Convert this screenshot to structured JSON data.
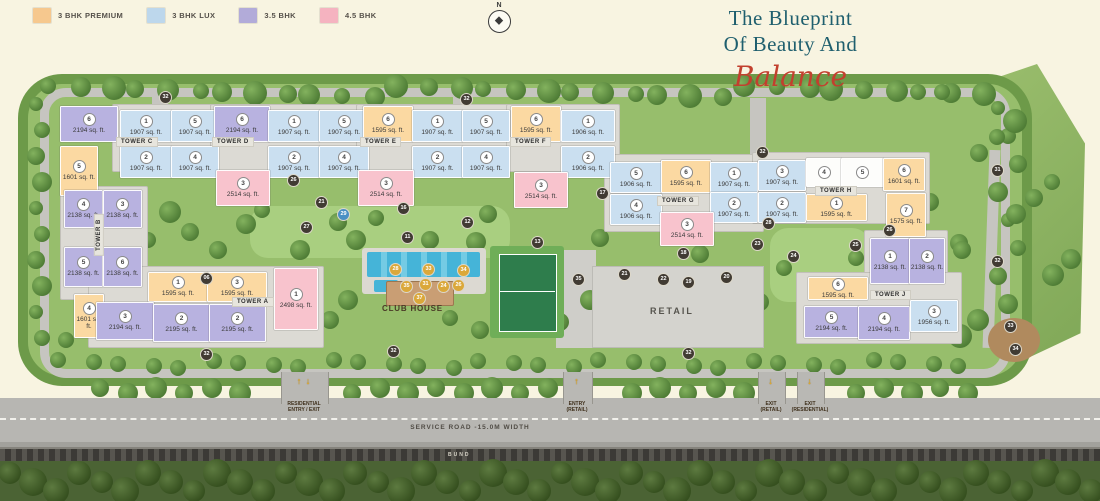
{
  "legend": {
    "items": [
      {
        "label": "3 BHK PREMIUM",
        "key": "premium"
      },
      {
        "label": "3 BHK LUX",
        "key": "lux"
      },
      {
        "label": "3.5 BHK",
        "key": "bhk35"
      },
      {
        "label": "4.5 BHK",
        "key": "bhk45"
      }
    ]
  },
  "colors": {
    "premium": "#f6c88e",
    "lux": "#bdd7ec",
    "bhk35": "#b2abd9",
    "bhk45": "#f5b3c0",
    "white": "#fdfdfb",
    "unit_premium": "#fbd9a2",
    "unit_lux": "#cadff0",
    "unit_bhk35": "#b8b2e0",
    "unit_bhk45": "#f8c3cd",
    "title_teal": "#1f5f6e",
    "script_red": "#c2402e"
  },
  "title": {
    "line1": "The Blueprint",
    "line2": "Of Beauty And",
    "script": "Balance"
  },
  "compass": {
    "label": "N"
  },
  "plan": {
    "club_house_label": "CLUB HOUSE",
    "retail_label": "RETAIL",
    "tower_labels": [
      {
        "text": "TOWER C",
        "x": 116,
        "y": 137
      },
      {
        "text": "TOWER D",
        "x": 212,
        "y": 137
      },
      {
        "text": "TOWER E",
        "x": 360,
        "y": 137
      },
      {
        "text": "TOWER F",
        "x": 510,
        "y": 137
      },
      {
        "text": "TOWER G",
        "x": 657,
        "y": 196
      },
      {
        "text": "TOWER H",
        "x": 815,
        "y": 186
      },
      {
        "text": "TOWER J",
        "x": 870,
        "y": 290
      },
      {
        "text": "TOWER A",
        "x": 232,
        "y": 297
      },
      {
        "text": "TOWER B",
        "x": 78,
        "y": 230,
        "v": true
      }
    ],
    "units": [
      {
        "t": "C",
        "n": "6",
        "s": "2194 sq. ft.",
        "c": "bhk35",
        "x": 60,
        "y": 106,
        "w": 56,
        "h": 34
      },
      {
        "t": "C",
        "n": "5",
        "s": "1601 sq. ft.",
        "c": "premium",
        "x": 60,
        "y": 146,
        "w": 36,
        "h": 48
      },
      {
        "t": "C",
        "n": "1",
        "s": "1907 sq. ft.",
        "c": "lux",
        "x": 120,
        "y": 110,
        "w": 50,
        "h": 30
      },
      {
        "t": "C",
        "n": "5",
        "s": "1907 sq. ft.",
        "c": "lux",
        "x": 171,
        "y": 110,
        "w": 46,
        "h": 30
      },
      {
        "t": "C",
        "n": "2",
        "s": "1907 sq. ft.",
        "c": "lux",
        "x": 120,
        "y": 146,
        "w": 50,
        "h": 30
      },
      {
        "t": "C",
        "n": "4",
        "s": "1907 sq. ft.",
        "c": "lux",
        "x": 171,
        "y": 146,
        "w": 46,
        "h": 30
      },
      {
        "t": "D",
        "n": "6",
        "s": "2194 sq. ft.",
        "c": "bhk35",
        "x": 214,
        "y": 106,
        "w": 54,
        "h": 34
      },
      {
        "t": "D",
        "n": "1",
        "s": "1907 sq. ft.",
        "c": "lux",
        "x": 268,
        "y": 110,
        "w": 50,
        "h": 30
      },
      {
        "t": "D",
        "n": "5",
        "s": "1907 sq. ft.",
        "c": "lux",
        "x": 319,
        "y": 110,
        "w": 48,
        "h": 30
      },
      {
        "t": "D",
        "n": "2",
        "s": "1907 sq. ft.",
        "c": "lux",
        "x": 268,
        "y": 146,
        "w": 50,
        "h": 30
      },
      {
        "t": "D",
        "n": "4",
        "s": "1907 sq. ft.",
        "c": "lux",
        "x": 319,
        "y": 146,
        "w": 48,
        "h": 30
      },
      {
        "t": "D",
        "n": "3",
        "s": "2514 sq. ft.",
        "c": "bhk45",
        "x": 216,
        "y": 170,
        "w": 52,
        "h": 34
      },
      {
        "t": "E",
        "n": "6",
        "s": "1595 sq. ft.",
        "c": "premium",
        "x": 363,
        "y": 106,
        "w": 48,
        "h": 34
      },
      {
        "t": "E",
        "n": "1",
        "s": "1907 sq. ft.",
        "c": "lux",
        "x": 412,
        "y": 110,
        "w": 49,
        "h": 30
      },
      {
        "t": "E",
        "n": "5",
        "s": "1907 sq. ft.",
        "c": "lux",
        "x": 462,
        "y": 110,
        "w": 46,
        "h": 30
      },
      {
        "t": "E",
        "n": "2",
        "s": "1907 sq. ft.",
        "c": "lux",
        "x": 412,
        "y": 146,
        "w": 49,
        "h": 30
      },
      {
        "t": "E",
        "n": "4",
        "s": "1907 sq. ft.",
        "c": "lux",
        "x": 462,
        "y": 146,
        "w": 46,
        "h": 30
      },
      {
        "t": "E",
        "n": "3",
        "s": "2514 sq. ft.",
        "c": "bhk45",
        "x": 358,
        "y": 170,
        "w": 54,
        "h": 34
      },
      {
        "t": "F",
        "n": "6",
        "s": "1595 sq. ft.",
        "c": "premium",
        "x": 511,
        "y": 106,
        "w": 48,
        "h": 34
      },
      {
        "t": "F",
        "n": "1",
        "s": "1906 sq. ft.",
        "c": "lux",
        "x": 561,
        "y": 110,
        "w": 52,
        "h": 30
      },
      {
        "t": "F",
        "n": "2",
        "s": "1906 sq. ft.",
        "c": "lux",
        "x": 561,
        "y": 146,
        "w": 52,
        "h": 30
      },
      {
        "t": "F",
        "n": "3",
        "s": "2514 sq. ft.",
        "c": "bhk45",
        "x": 514,
        "y": 172,
        "w": 52,
        "h": 34
      },
      {
        "t": "G",
        "n": "5",
        "s": "1906 sq. ft.",
        "c": "lux",
        "x": 610,
        "y": 162,
        "w": 50,
        "h": 29
      },
      {
        "t": "G",
        "n": "6",
        "s": "1595 sq. ft.",
        "c": "premium",
        "x": 661,
        "y": 160,
        "w": 48,
        "h": 31
      },
      {
        "t": "G",
        "n": "1",
        "s": "1907 sq. ft.",
        "c": "lux",
        "x": 710,
        "y": 162,
        "w": 46,
        "h": 29
      },
      {
        "t": "G",
        "n": "4",
        "s": "1906 sq. ft.",
        "c": "lux",
        "x": 610,
        "y": 194,
        "w": 50,
        "h": 29
      },
      {
        "t": "G",
        "n": "2",
        "s": "1907 sq. ft.",
        "c": "lux",
        "x": 710,
        "y": 192,
        "w": 46,
        "h": 29
      },
      {
        "t": "G",
        "n": "3",
        "s": "2514 sq. ft.",
        "c": "bhk45",
        "x": 660,
        "y": 212,
        "w": 52,
        "h": 32
      },
      {
        "t": "H",
        "n": "3",
        "s": "1907 sq. ft.",
        "c": "lux",
        "x": 758,
        "y": 160,
        "w": 46,
        "h": 29
      },
      {
        "t": "H",
        "n": "4",
        "s": "",
        "c": "white",
        "x": 806,
        "y": 158,
        "w": 34,
        "h": 27
      },
      {
        "t": "H",
        "n": "5",
        "s": "",
        "c": "white",
        "x": 841,
        "y": 158,
        "w": 41,
        "h": 27
      },
      {
        "t": "H",
        "n": "6",
        "s": "1601 sq. ft.",
        "c": "premium",
        "x": 883,
        "y": 158,
        "w": 40,
        "h": 31
      },
      {
        "t": "H",
        "n": "2",
        "s": "1907 sq. ft.",
        "c": "lux",
        "x": 758,
        "y": 192,
        "w": 46,
        "h": 29
      },
      {
        "t": "H",
        "n": "1",
        "s": "1595 sq. ft.",
        "c": "premium",
        "x": 806,
        "y": 194,
        "w": 59,
        "h": 25
      },
      {
        "t": "H",
        "n": "7",
        "s": "1575 sq. ft.",
        "c": "premium",
        "x": 886,
        "y": 193,
        "w": 38,
        "h": 42
      },
      {
        "t": "J",
        "n": "1",
        "s": "2138 sq. ft.",
        "c": "bhk35",
        "x": 870,
        "y": 238,
        "w": 38,
        "h": 44
      },
      {
        "t": "J",
        "n": "2",
        "s": "2138 sq. ft.",
        "c": "bhk35",
        "x": 909,
        "y": 238,
        "w": 34,
        "h": 44
      },
      {
        "t": "J",
        "n": "6",
        "s": "1595 sq. ft.",
        "c": "premium",
        "x": 808,
        "y": 277,
        "w": 58,
        "h": 21
      },
      {
        "t": "J",
        "n": "5",
        "s": "2194 sq. ft.",
        "c": "bhk35",
        "x": 804,
        "y": 306,
        "w": 53,
        "h": 30
      },
      {
        "t": "J",
        "n": "4",
        "s": "2194 sq. ft.",
        "c": "bhk35",
        "x": 858,
        "y": 306,
        "w": 50,
        "h": 32
      },
      {
        "t": "J",
        "n": "3",
        "s": "1956 sq. ft.",
        "c": "lux",
        "x": 910,
        "y": 300,
        "w": 46,
        "h": 30
      },
      {
        "t": "B",
        "n": "4",
        "s": "2138 sq. ft.",
        "c": "bhk35",
        "x": 64,
        "y": 190,
        "w": 37,
        "h": 36
      },
      {
        "t": "B",
        "n": "3",
        "s": "2138 sq. ft.",
        "c": "bhk35",
        "x": 103,
        "y": 190,
        "w": 37,
        "h": 36
      },
      {
        "t": "B",
        "n": "5",
        "s": "2138 sq. ft.",
        "c": "bhk35",
        "x": 64,
        "y": 247,
        "w": 37,
        "h": 38
      },
      {
        "t": "B",
        "n": "6",
        "s": "2138 sq. ft.",
        "c": "bhk35",
        "x": 103,
        "y": 247,
        "w": 37,
        "h": 38
      },
      {
        "t": "B",
        "n": "4",
        "s": "1601 sq. ft.",
        "c": "premium",
        "x": 74,
        "y": 294,
        "w": 28,
        "h": 42
      },
      {
        "t": "A",
        "n": "1",
        "s": "1595 sq. ft.",
        "c": "premium",
        "x": 148,
        "y": 272,
        "w": 58,
        "h": 28
      },
      {
        "t": "A",
        "n": "3",
        "s": "1595 sq. ft.",
        "c": "premium",
        "x": 207,
        "y": 272,
        "w": 58,
        "h": 28
      },
      {
        "t": "A",
        "n": "1",
        "s": "2498 sq. ft.",
        "c": "bhk45",
        "x": 274,
        "y": 268,
        "w": 42,
        "h": 60
      },
      {
        "t": "A",
        "n": "3",
        "s": "2194 sq. ft.",
        "c": "bhk35",
        "x": 96,
        "y": 302,
        "w": 56,
        "h": 36
      },
      {
        "t": "A",
        "n": "2",
        "s": "2195 sq. ft.",
        "c": "bhk35",
        "x": 153,
        "y": 304,
        "w": 55,
        "h": 36
      },
      {
        "t": "A",
        "n": "2",
        "s": "2195 sq. ft.",
        "c": "bhk35",
        "x": 209,
        "y": 304,
        "w": 55,
        "h": 36
      }
    ],
    "markers": [
      {
        "n": "32",
        "x": 159,
        "y": 91
      },
      {
        "n": "32",
        "x": 460,
        "y": 93
      },
      {
        "n": "32",
        "x": 756,
        "y": 146
      },
      {
        "n": "31",
        "x": 991,
        "y": 164
      },
      {
        "n": "32",
        "x": 991,
        "y": 255
      },
      {
        "n": "33",
        "x": 1004,
        "y": 320
      },
      {
        "n": "34",
        "x": 1009,
        "y": 343
      },
      {
        "n": "32",
        "x": 200,
        "y": 348
      },
      {
        "n": "32",
        "x": 387,
        "y": 345
      },
      {
        "n": "32",
        "x": 682,
        "y": 347
      },
      {
        "n": "06",
        "x": 200,
        "y": 272
      },
      {
        "n": "26",
        "x": 287,
        "y": 174
      },
      {
        "n": "21",
        "x": 315,
        "y": 196
      },
      {
        "n": "27",
        "x": 300,
        "y": 221
      },
      {
        "n": "29",
        "x": 337,
        "y": 208,
        "k": "blue"
      },
      {
        "n": "16",
        "x": 397,
        "y": 202
      },
      {
        "n": "11",
        "x": 401,
        "y": 231
      },
      {
        "n": "12",
        "x": 461,
        "y": 216
      },
      {
        "n": "13",
        "x": 531,
        "y": 236
      },
      {
        "n": "17",
        "x": 596,
        "y": 187
      },
      {
        "n": "18",
        "x": 677,
        "y": 247
      },
      {
        "n": "28",
        "x": 762,
        "y": 217
      },
      {
        "n": "23",
        "x": 751,
        "y": 238
      },
      {
        "n": "26",
        "x": 883,
        "y": 224
      },
      {
        "n": "25",
        "x": 849,
        "y": 239
      },
      {
        "n": "24",
        "x": 787,
        "y": 250
      },
      {
        "n": "35",
        "x": 572,
        "y": 273
      },
      {
        "n": "21",
        "x": 618,
        "y": 268
      },
      {
        "n": "22",
        "x": 657,
        "y": 273
      },
      {
        "n": "19",
        "x": 682,
        "y": 276
      },
      {
        "n": "20",
        "x": 720,
        "y": 271
      },
      {
        "n": "28",
        "x": 389,
        "y": 263,
        "k": "y"
      },
      {
        "n": "33",
        "x": 422,
        "y": 263,
        "k": "y"
      },
      {
        "n": "34",
        "x": 457,
        "y": 264,
        "k": "y"
      },
      {
        "n": "35",
        "x": 400,
        "y": 280,
        "k": "y"
      },
      {
        "n": "31",
        "x": 419,
        "y": 278,
        "k": "y"
      },
      {
        "n": "24",
        "x": 437,
        "y": 280,
        "k": "y"
      },
      {
        "n": "26",
        "x": 452,
        "y": 279,
        "k": "y"
      },
      {
        "n": "37",
        "x": 413,
        "y": 292,
        "k": "y"
      }
    ]
  },
  "roads": {
    "service_label": "SERVICE ROAD -15.0M WIDTH",
    "bund_label": "BUND"
  },
  "gates": [
    {
      "line1": "RESIDENTIAL",
      "line2": "ENTRY / EXIT",
      "x": 281,
      "w": 46,
      "arrows": [
        "up",
        "down"
      ]
    },
    {
      "line1": "ENTRY",
      "line2": "(RETAIL)",
      "x": 563,
      "w": 28,
      "arrows": [
        "up"
      ]
    },
    {
      "line1": "EXIT",
      "line2": "(RETAIL)",
      "x": 758,
      "w": 26,
      "arrows": [
        "down"
      ]
    },
    {
      "line1": "EXIT",
      "line2": "(RESIDENTIAL)",
      "x": 797,
      "w": 26,
      "arrows": [
        "down"
      ]
    }
  ]
}
